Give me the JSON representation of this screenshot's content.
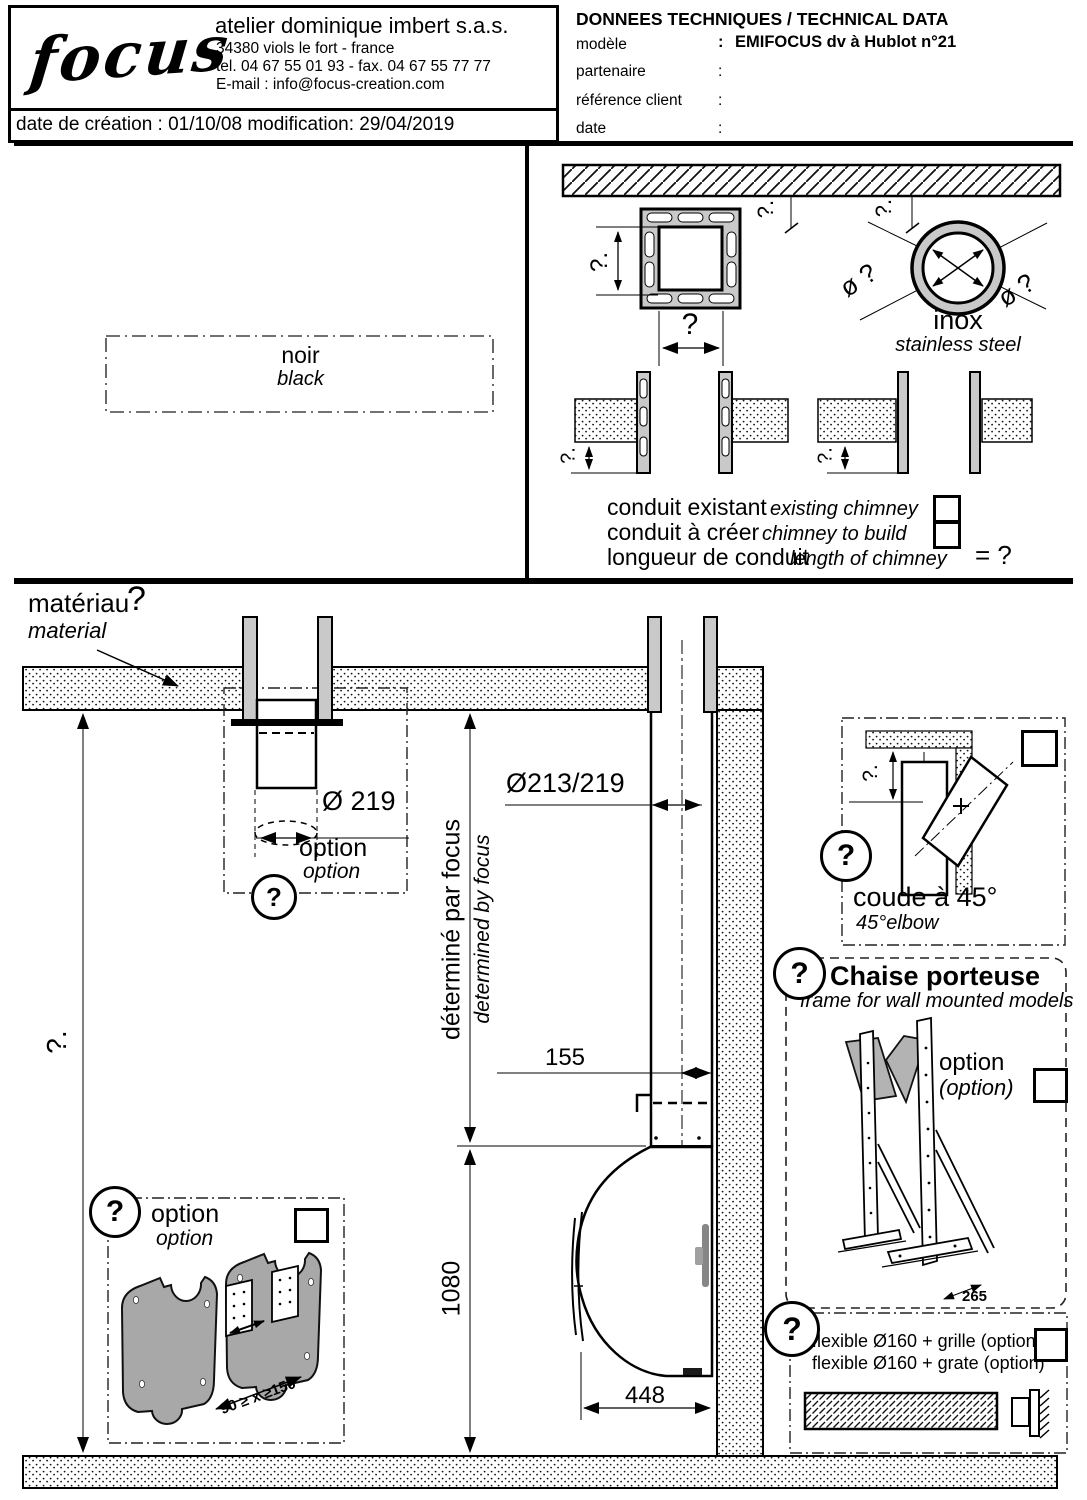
{
  "header": {
    "logo": "focus",
    "company": "atelier dominique imbert s.a.s.",
    "address": "34380 viols le fort  -   france",
    "telfax": "tel. 04 67 55 01 93  -   fax. 04 67 55 77 77",
    "email": "E-mail : info@focus-creation.com",
    "dateline": "date de création : 01/10/08  modification: 29/04/2019"
  },
  "tech": {
    "title": "DONNEES TECHNIQUES / TECHNICAL DATA",
    "rows": [
      {
        "label": "modèle",
        "colon": ":",
        "value": "EMIFOCUS dv à Hublot  n°21"
      },
      {
        "label": "partenaire",
        "colon": ":",
        "value": ""
      },
      {
        "label": "référence client",
        "colon": ":",
        "value": ""
      },
      {
        "label": "date",
        "colon": ":",
        "value": ""
      }
    ]
  },
  "top": {
    "noir_fr": "noir",
    "noir_en": "black",
    "inox_fr": "inox",
    "inox_en": "stainless steel",
    "dia_left": "ø ?",
    "dia_right": "ø ?",
    "q_sq_v": "?.",
    "q_sq_h": "?",
    "q_ceiling_1": "?.",
    "q_ceiling_2": "?.",
    "q_depth_l": "?.",
    "q_depth_r": "?.",
    "conduit": [
      {
        "fr": "conduit existant",
        "en": "existing chimney"
      },
      {
        "fr": "conduit à créer",
        "en": "chimney to build"
      },
      {
        "fr": "longueur de conduit",
        "en": "length of chimney",
        "eq": "= ?"
      }
    ]
  },
  "main": {
    "materiau_fr": "matériau",
    "materiau_q": "?",
    "materiau_en": "material",
    "option_top": {
      "dim": "Ø 219",
      "fr": "option",
      "en": "option",
      "q": "?"
    },
    "pipe_dim": "Ø213/219",
    "det_fr": "déterminé par focus",
    "det_en": "determined by focus",
    "dim155": "155",
    "dim1080": "1080",
    "dim448": "448",
    "q_left": "?.",
    "coude": {
      "q": "?",
      "dim_q": "?.",
      "fr": "coude à 45°",
      "en": "45°elbow"
    },
    "chaise": {
      "q": "?",
      "title": "Chaise porteuse",
      "subtitle": "frame for wall mounted models",
      "opt_fr": "option",
      "opt_en": "(option)",
      "dim": "265"
    },
    "flex": {
      "q": "?",
      "line1": "flexible Ø160 + grille (option)",
      "line2": "flexible Ø160 + grate (option)"
    },
    "shield": {
      "q": "?",
      "fr": "option",
      "en": "option",
      "dim": "90 ≥ x ≥150"
    }
  }
}
